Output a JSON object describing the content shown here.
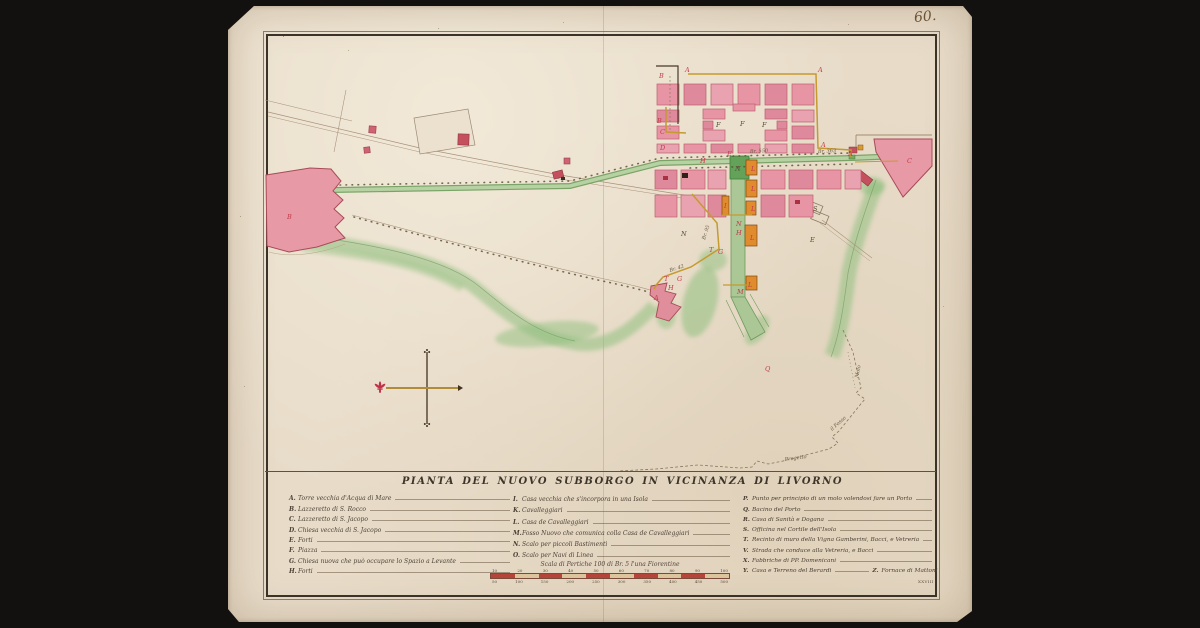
{
  "page": {
    "folio_number": "60.",
    "folio_mark": "XXVIII"
  },
  "title": "PIANTA DEL NUOVO SUBBORGO IN VICINANZA DI LIVORNO",
  "legend": {
    "col1": [
      {
        "letter": "A.",
        "label": "Torre vecchia d'Acqua di Mare"
      },
      {
        "letter": "B.",
        "label": "Lazzeretto di S. Rocco"
      },
      {
        "letter": "C.",
        "label": "Lazzeretto di S. Jacopo"
      },
      {
        "letter": "D.",
        "label": "Chiesa vecchia di S. Jacopo"
      },
      {
        "letter": "E.",
        "label": "Forti"
      },
      {
        "letter": "F.",
        "label": "Piazza"
      },
      {
        "letter": "G.",
        "label": "Chiesa nuova che può occupare lo Spazio a Levante"
      },
      {
        "letter": "H.",
        "label": "Forti"
      }
    ],
    "col2": [
      {
        "letter": "I.",
        "label": "Casa vecchia che s'incorpora in una Isola"
      },
      {
        "letter": "K.",
        "label": "Cavalleggiari"
      },
      {
        "letter": "L.",
        "label": "Casa de Cavalleggiari"
      },
      {
        "letter": "M.",
        "label": "Fosso Nuovo che comunica colla Casa de Cavalleggiari"
      },
      {
        "letter": "N.",
        "label": "Scalo per piccoli Bastimenti"
      },
      {
        "letter": "O.",
        "label": "Scalo per Navi di Linea"
      }
    ],
    "col3": [
      {
        "letter": "P.",
        "label": "Punto per principio di un molo volendosi fare un Porto"
      },
      {
        "letter": "Q.",
        "label": "Bacino del Porto"
      },
      {
        "letter": "R.",
        "label": "Casa di Sanità e Dogana"
      },
      {
        "letter": "S.",
        "label": "Officina nel Cortile dell'Isola"
      },
      {
        "letter": "T.",
        "label": "Recinto di muro della Vigna Gamberini, Bacci, e Vetreria"
      },
      {
        "letter": "V.",
        "label": "Strada che conduce alla Vetreria, e Bacci"
      },
      {
        "letter": "X.",
        "label": "Fabbriche di PP. Domenicani"
      },
      {
        "letter": "Y.",
        "label": "Casa e Terreno del Berardi"
      }
    ],
    "z_entry": {
      "letter": "Z.",
      "label": "Fornace di Mattoni"
    }
  },
  "scale": {
    "caption": "Scala di Pertiche 100 di Br. 5 l'una Fiorentine",
    "top_ticks": [
      "10",
      "20",
      "30",
      "40",
      "50",
      "60",
      "70",
      "80",
      "90",
      "100"
    ],
    "bottom_ticks": [
      "50",
      "100",
      "150",
      "200",
      "250",
      "300",
      "350",
      "400",
      "450",
      "500"
    ]
  },
  "map": {
    "letters": [
      "B",
      "A",
      "A",
      "B",
      "C",
      "D",
      "A",
      "A",
      "F",
      "F",
      "F",
      "E",
      "H",
      "N",
      "L",
      "L",
      "L",
      "I",
      "N",
      "H",
      "L",
      "T",
      "G",
      "G",
      "T",
      "H",
      "A",
      "M",
      "Q",
      "B",
      "C",
      "N",
      "S",
      "E",
      "L"
    ],
    "annotations": [
      "Br. 550",
      "Br. 363",
      "Br. 95",
      "Br. 42",
      "Molo",
      "il Fosso",
      "Progetto"
    ]
  },
  "colors": {
    "paper": "#e8dcc9",
    "ink": "#4c4034",
    "block_pink": "#e795a5",
    "fort_pink": "#e79aa6",
    "dark_red": "#b03540",
    "orange": "#e08b2d",
    "canal_green": "#aac795",
    "vegetation": "#8fbf7e",
    "ochre_line": "#c59a2f",
    "letter_red": "#c23a4a"
  }
}
